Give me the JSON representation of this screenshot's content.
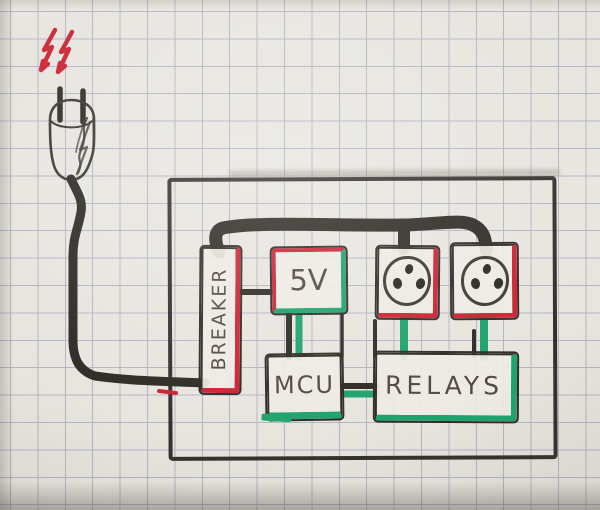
{
  "diagram": {
    "description": "Hand-drawn mains wiring sketch on squared paper",
    "components": {
      "breaker": {
        "label": "BREAKER"
      },
      "psu": {
        "label": "5V"
      },
      "mcu": {
        "label": "MCU"
      },
      "relays": {
        "label": "RELAYS"
      }
    },
    "icons": {
      "hazard_lightning": "double red lightning bolts",
      "power_plug": "two-prong mains plug with cord",
      "outlet_socket_1": "round socket face with three holes",
      "outlet_socket_2": "round socket face with three holes"
    }
  },
  "colors": {
    "ink": "#2f2b26",
    "live_red": "#cc2333",
    "wire_green": "#1fa36c",
    "pencil": "#4f4a43",
    "paper": "#e8e5df",
    "grid_line": "#7d86ad"
  }
}
